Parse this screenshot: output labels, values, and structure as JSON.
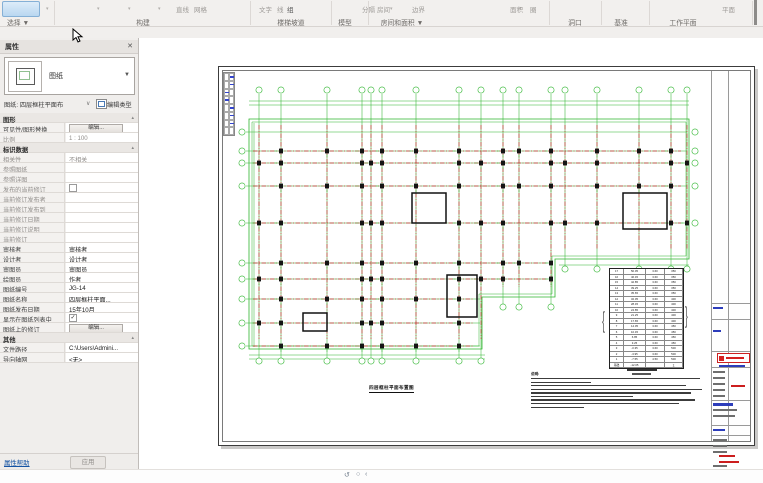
{
  "ribbon": {
    "select_label": "选择 ▼",
    "panels": [
      "构建",
      "楼梯坡道",
      "模型",
      "房间和面积 ▼",
      "洞口",
      "基准",
      "工作平面"
    ],
    "ghost_items": [
      "直线",
      "网格",
      "文字",
      "线",
      "组",
      "分隔",
      "房间",
      "边界",
      "面积",
      "圈",
      "平面"
    ]
  },
  "properties": {
    "title": "属性",
    "close_glyph": "✕",
    "type_label": "图纸",
    "type_arrow": "▼",
    "instance_label": "图纸: 四层框柱平面布",
    "instance_arrow": "∨",
    "edit_type_label": "编辑类型",
    "rows": [
      {
        "t": "h",
        "l": "图形"
      },
      {
        "t": "btn",
        "l": "可见性/图形替换",
        "v": "编辑..."
      },
      {
        "t": "r",
        "l": "比例",
        "v": "1 : 100",
        "dim": true
      },
      {
        "t": "h",
        "l": "标识数据"
      },
      {
        "t": "r",
        "l": "相关性",
        "v": "不相关",
        "dim": true
      },
      {
        "t": "r",
        "l": "参照图纸",
        "v": "",
        "dim": true
      },
      {
        "t": "r",
        "l": "参照详图",
        "v": "",
        "dim": true
      },
      {
        "t": "chk",
        "l": "发布的当前修订",
        "v": false,
        "dim": true
      },
      {
        "t": "r",
        "l": "当前修订发布者",
        "v": "",
        "dim": true
      },
      {
        "t": "r",
        "l": "当前修订发布到",
        "v": "",
        "dim": true
      },
      {
        "t": "r",
        "l": "当前修订日期",
        "v": "",
        "dim": true
      },
      {
        "t": "r",
        "l": "当前修订说明",
        "v": "",
        "dim": true
      },
      {
        "t": "r",
        "l": "当前修订",
        "v": "",
        "dim": true
      },
      {
        "t": "r",
        "l": "审核者",
        "v": "审核者"
      },
      {
        "t": "r",
        "l": "设计者",
        "v": "设计者"
      },
      {
        "t": "r",
        "l": "审图员",
        "v": "审图员"
      },
      {
        "t": "r",
        "l": "绘图员",
        "v": "作者"
      },
      {
        "t": "r",
        "l": "图纸编号",
        "v": "JG-14"
      },
      {
        "t": "r",
        "l": "图纸名称",
        "v": "四层框柱平面..."
      },
      {
        "t": "r",
        "l": "图纸发布日期",
        "v": "15年10月"
      },
      {
        "t": "chk",
        "l": "显示在图纸列表中",
        "v": true
      },
      {
        "t": "btn",
        "l": "图纸上的修订",
        "v": "编辑..."
      },
      {
        "t": "h",
        "l": "其他"
      },
      {
        "t": "r",
        "l": "文件路径",
        "v": "C:\\Users\\Admini..."
      },
      {
        "t": "r",
        "l": "导向轴网",
        "v": "<无>"
      }
    ],
    "help_label": "属性帮助",
    "apply_label": "应用"
  },
  "sheet": {
    "plan_title": "四层框柱平面布置图",
    "schedule_rows": [
      [
        "17",
        "50.05",
        "3.60",
        "350"
      ],
      [
        "16",
        "46.45",
        "3.60",
        "350"
      ],
      [
        "15",
        "42.85",
        "3.60",
        "350"
      ],
      [
        "14",
        "39.25",
        "3.60",
        "350"
      ],
      [
        "13",
        "35.65",
        "3.60",
        "350"
      ],
      [
        "12",
        "32.05",
        "3.60",
        "400"
      ],
      [
        "11",
        "28.45",
        "3.60",
        "400"
      ],
      [
        "10",
        "24.85",
        "3.60",
        "400"
      ],
      [
        "9",
        "21.25",
        "3.60",
        "400"
      ],
      [
        "8",
        "17.65",
        "3.60",
        "400"
      ],
      [
        "7",
        "14.05",
        "3.60",
        "450"
      ],
      [
        "6",
        "10.45",
        "3.60",
        "450"
      ],
      [
        "5",
        "6.85",
        "3.60",
        "450"
      ],
      [
        "4",
        "3.25",
        "3.60",
        "450"
      ],
      [
        "3",
        "-0.35",
        "3.60",
        "500"
      ],
      [
        "2",
        "-3.95",
        "3.60",
        "500"
      ],
      [
        "1",
        "-7.55",
        "4.50",
        "500"
      ],
      [
        "基础",
        "-12.05",
        "",
        "∑"
      ]
    ],
    "notes_title": "说明:",
    "notes_lines": [
      96,
      34,
      88,
      97,
      91,
      58,
      93,
      84,
      30
    ]
  },
  "status_icons": [
    "↺",
    "○",
    "‹"
  ],
  "colors": {
    "grid_green": "#2fb52f",
    "beam_red": "#c52f2f",
    "column_black": "#151515",
    "accent_blue": "#1553a3"
  }
}
